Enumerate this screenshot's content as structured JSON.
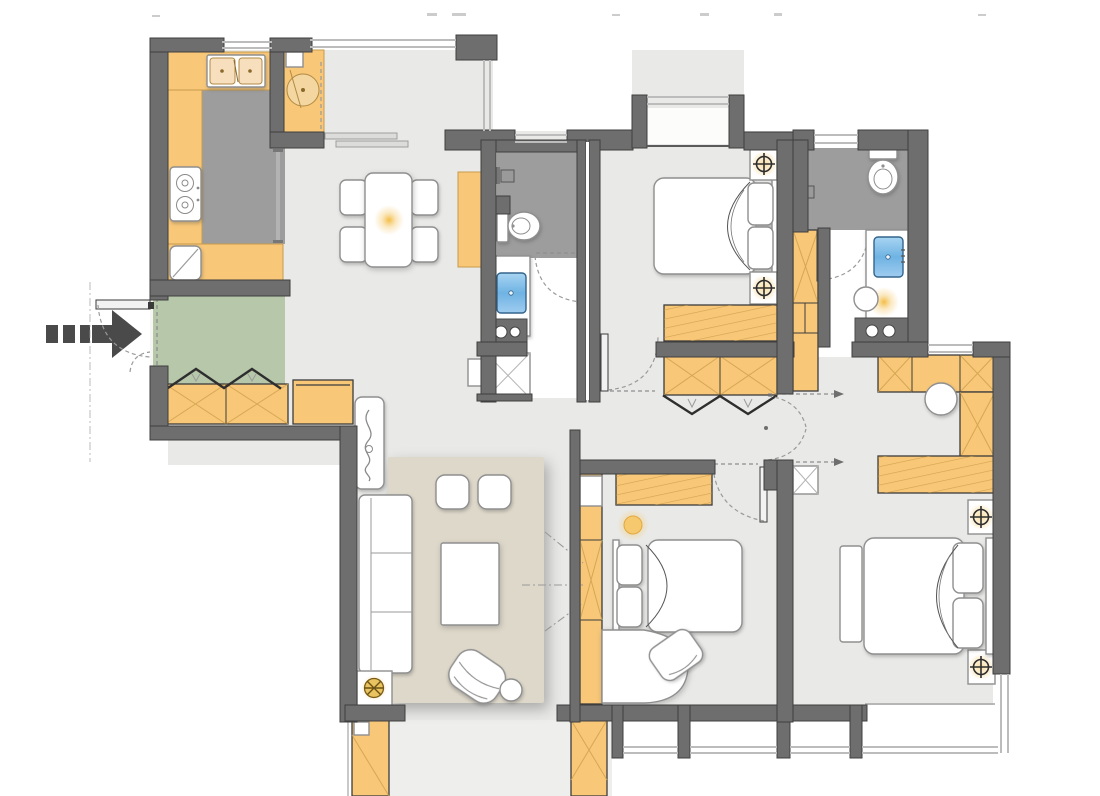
{
  "meta": {
    "title": "Apartment floor plan",
    "view": "top-down architectural drawing, no text labels",
    "canvas": {
      "width": 1100,
      "height": 796
    }
  },
  "colors": {
    "bg": "#ffffff",
    "floor": "#e9e9e7",
    "wetFloor": "#9d9d9d",
    "entryMat": "#b7c7aa",
    "rug": "#ded8ca",
    "wall": "#6e6e6e",
    "wallEdge": "#3f3f3f",
    "cabinet": "#f8c778",
    "cabinetEdge": "#c79b4b",
    "cabinetLine": "#cfa14e",
    "white": "#ffffff",
    "furnEdge": "#8f8f8f",
    "sinkBlue": "#7fbfe8",
    "glowGold": "#f2b52f",
    "lampGold": "#e9c35f",
    "window": "#bcbcbc",
    "dash": "#8f8f8f",
    "arrowGray": "#4a4a4a",
    "darkAppliance": "#6e6e6e"
  },
  "rooms": [
    {
      "name": "kitchen"
    },
    {
      "name": "pantry-nook"
    },
    {
      "name": "dining-area"
    },
    {
      "name": "entry-foyer"
    },
    {
      "name": "hallway"
    },
    {
      "name": "bathroom-1"
    },
    {
      "name": "bedroom-1"
    },
    {
      "name": "bathroom-2"
    },
    {
      "name": "bedroom-2"
    },
    {
      "name": "master-bedroom"
    },
    {
      "name": "living-room"
    },
    {
      "name": "balcony"
    }
  ],
  "furniture": {
    "kitchen": [
      "u-shaped-counter",
      "double-basin-sink",
      "two-burner-stove",
      "corner-appliance",
      "sliding-partition"
    ],
    "pantry-nook": [
      "cabinet",
      "round-basin",
      "wall-shelves"
    ],
    "dining-area": [
      "dining-table",
      "four-chairs",
      "sideboard",
      "ceiling-glow"
    ],
    "entry-foyer": [
      "entry-mat",
      "entrance-door",
      "entrance-arrow",
      "shoe-cabinets",
      "coat-hooks"
    ],
    "bathroom-1": [
      "toilet",
      "vanity-sink",
      "washing-machine",
      "shower-stall",
      "towel-rail"
    ],
    "bedroom-1": [
      "double-bed",
      "two-nightstands",
      "two-ceiling-lamps",
      "dresser",
      "bay-window"
    ],
    "hallway": [
      "bifold-wardrobe",
      "tall-wardrobe",
      "storage-box",
      "double-swing-door"
    ],
    "bathroom-2": [
      "toilet",
      "vanity-sink",
      "washing-machine",
      "stool",
      "towel-rail"
    ],
    "bedroom-2": [
      "bed",
      "dresser",
      "desk",
      "chair",
      "wardrobe-column",
      "ceiling-lamp"
    ],
    "master-bedroom": [
      "double-bed",
      "two-nightstands",
      "two-ceiling-lamps",
      "wardrobe",
      "desk-with-chair",
      "dresser",
      "bench"
    ],
    "living-room": [
      "rug",
      "sofa",
      "coffee-table",
      "two-ottomans",
      "armchair",
      "side-ball-table",
      "floor-lamp",
      "plant-panel",
      "projection-guides"
    ],
    "balcony": [
      "left-cabinet",
      "right-cabinet"
    ]
  },
  "symbols": {
    "entrance-arrow": "dashed tail with solid arrowhead pointing right at entry door",
    "ceiling-lamp": "circle with crosshair over gold glow",
    "door-swing": "dashed quarter-circle arc with door leaf",
    "window": "double parallel light lines",
    "wardrobe-front": "zigzag bifold lines",
    "closet-x": "crossed diagonals on cabinet"
  }
}
